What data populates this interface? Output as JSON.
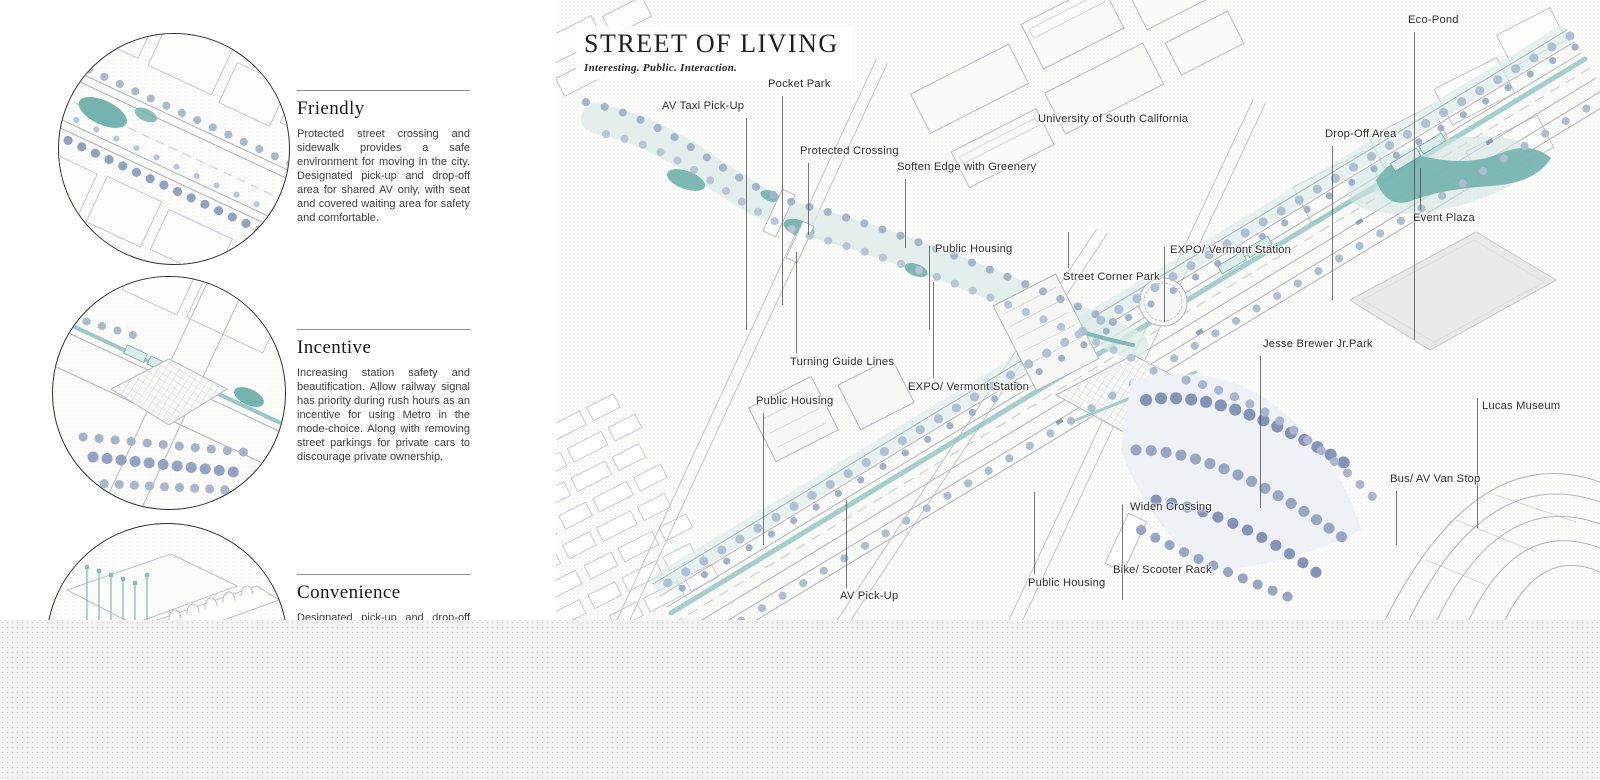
{
  "title_block": {
    "title": "STREET OF LIVING",
    "subtitle": "Interesting. Public. Interaction."
  },
  "sections": [
    {
      "title": "Friendly",
      "body": "Protected street crossing and sidewalk provides a safe environment for moving in the city. Designated pick-up and drop-off area for shared AV only, with seat and covered waiting area for safety and comfortable."
    },
    {
      "title": "Incentive",
      "body": "Increasing station safety and beautification. Allow railway signal has priority during rush hours as an incentive for using Metro in the mode-choice. Along with removing street parkings for private cars to discourage private ownership."
    },
    {
      "title": "Convenience",
      "body": "Designated pick-up and drop-off area"
    }
  ],
  "map": {
    "colors": {
      "water": "#72b2ae",
      "water_light": "#dcebe8",
      "tree_light": "#b0c0d3",
      "tree_dark": "#8394b7",
      "linework": "#b3b9c1",
      "label_text": "#2d2d2d"
    },
    "labels": [
      {
        "text": "AV Taxi Pick-Up",
        "x": 106,
        "y": 100,
        "leader": {
          "x": 190,
          "y1": 118,
          "y2": 330
        }
      },
      {
        "text": "Pocket Park",
        "x": 212,
        "y": 78,
        "leader": {
          "x": 226,
          "y1": 96,
          "y2": 305
        }
      },
      {
        "text": "Protected Crossing",
        "x": 244,
        "y": 145,
        "leader": {
          "x": 252,
          "y1": 163,
          "y2": 235
        }
      },
      {
        "text": "Soften Edge with Greenery",
        "x": 341,
        "y": 161,
        "leader": {
          "x": 349,
          "y1": 179,
          "y2": 248
        }
      },
      {
        "text": "University of South California",
        "x": 482,
        "y": 113
      },
      {
        "text": "Drop-Off Area",
        "x": 769,
        "y": 128,
        "leader": {
          "x": 776,
          "y1": 146,
          "y2": 300
        }
      },
      {
        "text": "Eco-Pond",
        "x": 852,
        "y": 14,
        "leader": {
          "x": 858,
          "y1": 32,
          "y2": 340
        }
      },
      {
        "text": "Event Plaza",
        "x": 857,
        "y": 212,
        "leader": {
          "x": 864,
          "y1": 168,
          "y2": 210
        }
      },
      {
        "text": "Public Housing",
        "x": 379,
        "y": 243,
        "leader": {
          "x": 373,
          "y1": 246,
          "y2": 330
        }
      },
      {
        "text": "Street Corner Park",
        "x": 507,
        "y": 271,
        "leader": {
          "x": 512,
          "y1": 232,
          "y2": 268
        }
      },
      {
        "text": "EXPO/ Vermont Station",
        "x": 614,
        "y": 244,
        "leader": {
          "x": 608,
          "y1": 247,
          "y2": 322
        }
      },
      {
        "text": "Turning Guide Lines",
        "x": 234,
        "y": 356,
        "leader": {
          "x": 240,
          "y1": 252,
          "y2": 353
        }
      },
      {
        "text": "EXPO/ Vermont Station",
        "x": 352,
        "y": 381,
        "leader": {
          "x": 377,
          "y1": 282,
          "y2": 378
        }
      },
      {
        "text": "Public Housing",
        "x": 200,
        "y": 395,
        "leader": {
          "x": 207,
          "y1": 413,
          "y2": 545
        }
      },
      {
        "text": "Jesse Brewer Jr.Park",
        "x": 707,
        "y": 338,
        "leader": {
          "x": 704,
          "y1": 356,
          "y2": 508
        }
      },
      {
        "text": "Lucas Museum",
        "x": 926,
        "y": 400,
        "leader": {
          "x": 921,
          "y1": 398,
          "y2": 528
        }
      },
      {
        "text": "Bus/ AV Van Stop",
        "x": 834,
        "y": 473,
        "leader": {
          "x": 840,
          "y1": 491,
          "y2": 545
        }
      },
      {
        "text": "Widen Crossing",
        "x": 574,
        "y": 501,
        "leader": {
          "x": 566,
          "y1": 505,
          "y2": 600
        }
      },
      {
        "text": "Bike/ Scooter Rack",
        "x": 557,
        "y": 564
      },
      {
        "text": "Public Housing",
        "x": 472,
        "y": 577,
        "leader": {
          "x": 478,
          "y1": 492,
          "y2": 574
        }
      },
      {
        "text": "AV Pick-Up",
        "x": 284,
        "y": 590,
        "leader": {
          "x": 290,
          "y1": 500,
          "y2": 588
        }
      }
    ]
  }
}
